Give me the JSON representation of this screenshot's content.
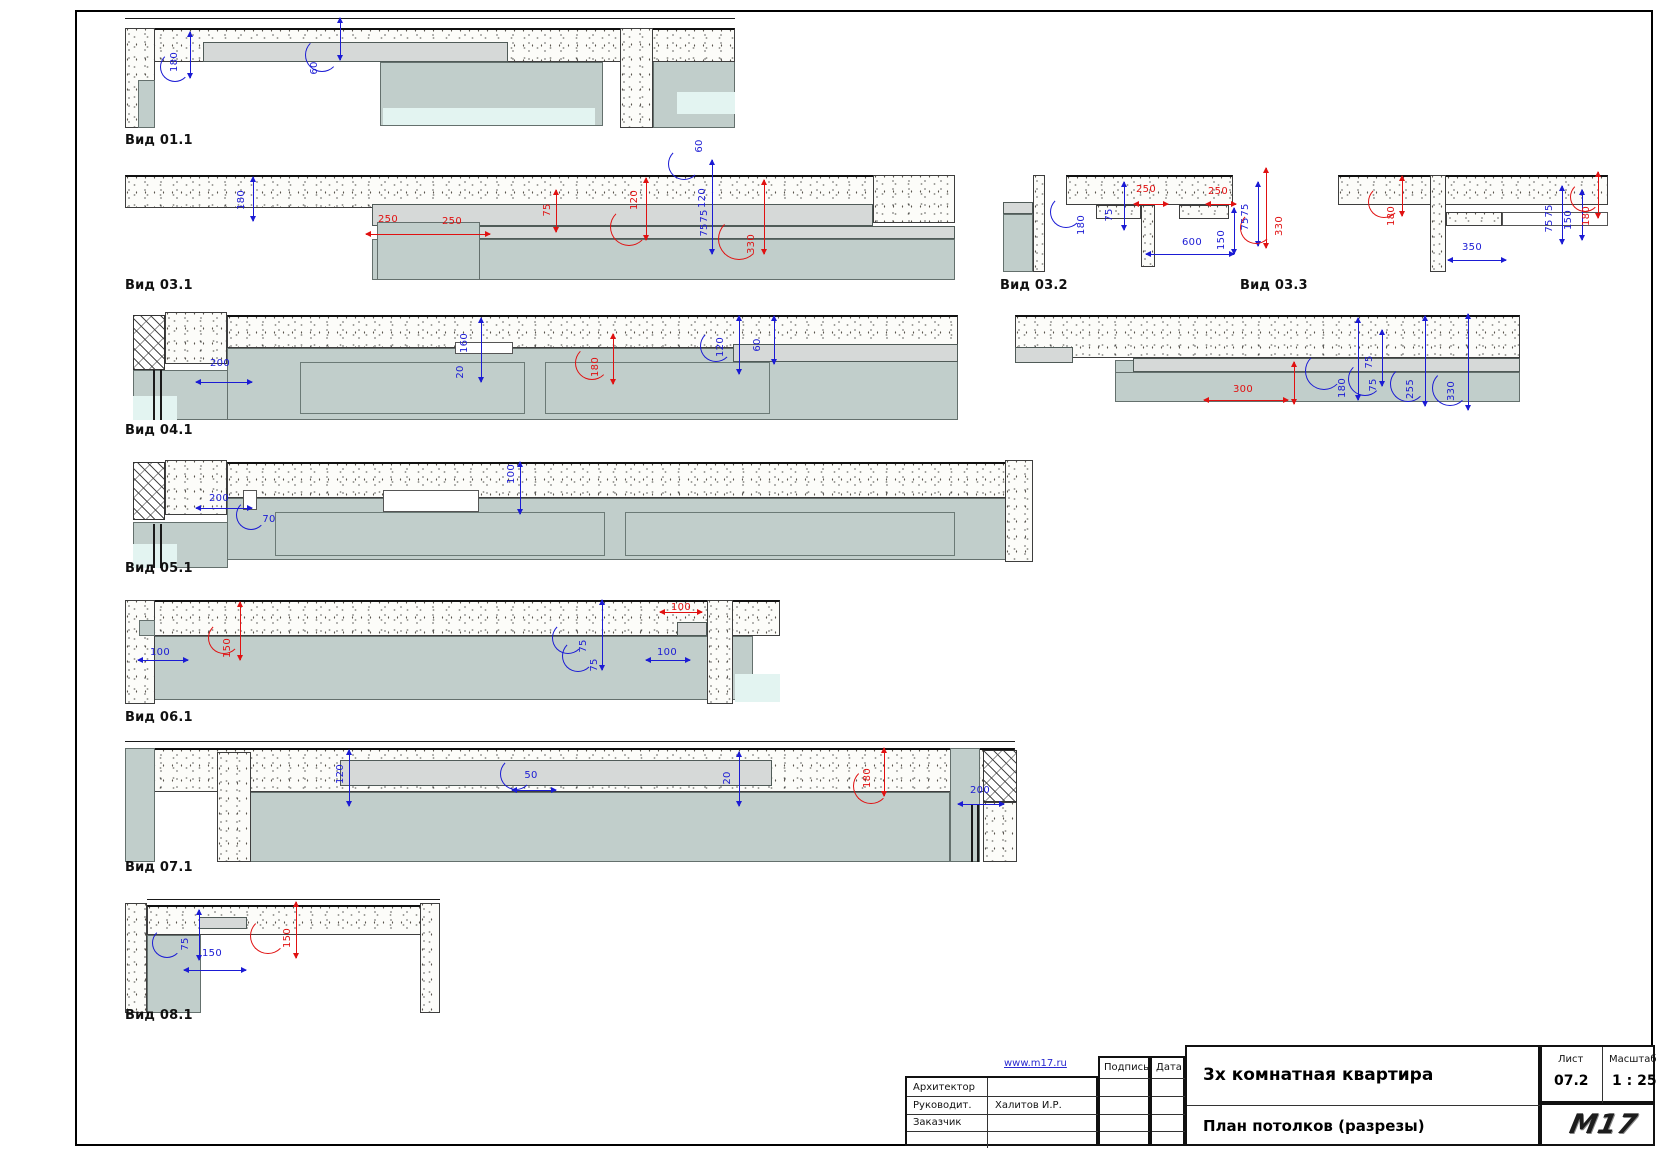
{
  "views": [
    {
      "label": "Вид 01.1"
    },
    {
      "label": "Вид 03.1"
    },
    {
      "label": "Вид 03.2"
    },
    {
      "label": "Вид 03.3"
    },
    {
      "label": "Вид 04.1"
    },
    {
      "label": "Вид 05.1"
    },
    {
      "label": "Вид 06.1"
    },
    {
      "label": "Вид 07.1"
    },
    {
      "label": "Вид 08.1"
    }
  ],
  "dimensions": [
    {
      "t": "180",
      "c": "b",
      "x": 175,
      "y": 62,
      "rot": true
    },
    {
      "t": "60",
      "c": "b",
      "x": 315,
      "y": 68,
      "rot": true
    },
    {
      "t": "180",
      "c": "b",
      "x": 242,
      "y": 200,
      "rot": true
    },
    {
      "t": "250",
      "c": "r",
      "x": 388,
      "y": 220,
      "rot": false
    },
    {
      "t": "250",
      "c": "r",
      "x": 452,
      "y": 222,
      "rot": false
    },
    {
      "t": "75",
      "c": "r",
      "x": 548,
      "y": 210,
      "rot": true
    },
    {
      "t": "120",
      "c": "r",
      "x": 635,
      "y": 200,
      "rot": true
    },
    {
      "t": "60",
      "c": "b",
      "x": 700,
      "y": 146,
      "rot": true
    },
    {
      "t": "120",
      "c": "b",
      "x": 703,
      "y": 198,
      "rot": true
    },
    {
      "t": "75",
      "c": "b",
      "x": 705,
      "y": 216,
      "rot": true
    },
    {
      "t": "75",
      "c": "b",
      "x": 705,
      "y": 230,
      "rot": true
    },
    {
      "t": "330",
      "c": "r",
      "x": 752,
      "y": 244,
      "rot": true
    },
    {
      "t": "180",
      "c": "b",
      "x": 1082,
      "y": 225,
      "rot": true
    },
    {
      "t": "75",
      "c": "b",
      "x": 1110,
      "y": 215,
      "rot": true
    },
    {
      "t": "250",
      "c": "r",
      "x": 1146,
      "y": 190,
      "rot": false
    },
    {
      "t": "250",
      "c": "r",
      "x": 1218,
      "y": 192,
      "rot": false
    },
    {
      "t": "600",
      "c": "b",
      "x": 1192,
      "y": 243,
      "rot": false
    },
    {
      "t": "150",
      "c": "b",
      "x": 1222,
      "y": 240,
      "rot": true
    },
    {
      "t": "75",
      "c": "b",
      "x": 1246,
      "y": 210,
      "rot": true
    },
    {
      "t": "75",
      "c": "b",
      "x": 1246,
      "y": 224,
      "rot": true
    },
    {
      "t": "330",
      "c": "r",
      "x": 1280,
      "y": 226,
      "rot": true
    },
    {
      "t": "180",
      "c": "r",
      "x": 1392,
      "y": 216,
      "rot": true
    },
    {
      "t": "350",
      "c": "b",
      "x": 1472,
      "y": 248,
      "rot": false
    },
    {
      "t": "75",
      "c": "b",
      "x": 1550,
      "y": 211,
      "rot": true
    },
    {
      "t": "75",
      "c": "b",
      "x": 1550,
      "y": 226,
      "rot": true
    },
    {
      "t": "150",
      "c": "b",
      "x": 1569,
      "y": 220,
      "rot": true
    },
    {
      "t": "180",
      "c": "r",
      "x": 1587,
      "y": 216,
      "rot": true
    },
    {
      "t": "200",
      "c": "b",
      "x": 220,
      "y": 364,
      "rot": false
    },
    {
      "t": "160",
      "c": "b",
      "x": 465,
      "y": 343,
      "rot": true
    },
    {
      "t": "20",
      "c": "b",
      "x": 461,
      "y": 372,
      "rot": true
    },
    {
      "t": "180",
      "c": "r",
      "x": 596,
      "y": 367,
      "rot": true
    },
    {
      "t": "120",
      "c": "b",
      "x": 721,
      "y": 347,
      "rot": true
    },
    {
      "t": "60",
      "c": "b",
      "x": 758,
      "y": 345,
      "rot": true
    },
    {
      "t": "300",
      "c": "r",
      "x": 1243,
      "y": 390,
      "rot": false
    },
    {
      "t": "180",
      "c": "b",
      "x": 1343,
      "y": 388,
      "rot": true
    },
    {
      "t": "75",
      "c": "b",
      "x": 1370,
      "y": 362,
      "rot": true
    },
    {
      "t": "75",
      "c": "b",
      "x": 1374,
      "y": 385,
      "rot": true
    },
    {
      "t": "255",
      "c": "b",
      "x": 1411,
      "y": 389,
      "rot": true
    },
    {
      "t": "330",
      "c": "b",
      "x": 1452,
      "y": 391,
      "rot": true
    },
    {
      "t": "200",
      "c": "b",
      "x": 219,
      "y": 499,
      "rot": false
    },
    {
      "t": "70",
      "c": "b",
      "x": 269,
      "y": 520,
      "rot": false
    },
    {
      "t": "100",
      "c": "b",
      "x": 512,
      "y": 474,
      "rot": true
    },
    {
      "t": "100",
      "c": "b",
      "x": 160,
      "y": 653,
      "rot": false
    },
    {
      "t": "150",
      "c": "r",
      "x": 228,
      "y": 648,
      "rot": true
    },
    {
      "t": "75",
      "c": "b",
      "x": 584,
      "y": 646,
      "rot": true
    },
    {
      "t": "75",
      "c": "b",
      "x": 595,
      "y": 665,
      "rot": true
    },
    {
      "t": "100",
      "c": "r",
      "x": 681,
      "y": 608,
      "rot": false
    },
    {
      "t": "100",
      "c": "b",
      "x": 667,
      "y": 653,
      "rot": false
    },
    {
      "t": "120",
      "c": "b",
      "x": 341,
      "y": 774,
      "rot": true
    },
    {
      "t": "50",
      "c": "b",
      "x": 531,
      "y": 776,
      "rot": false
    },
    {
      "t": "20",
      "c": "b",
      "x": 728,
      "y": 778,
      "rot": true
    },
    {
      "t": "180",
      "c": "r",
      "x": 868,
      "y": 778,
      "rot": true
    },
    {
      "t": "200",
      "c": "b",
      "x": 980,
      "y": 791,
      "rot": false
    },
    {
      "t": "75",
      "c": "b",
      "x": 186,
      "y": 944,
      "rot": true
    },
    {
      "t": "150",
      "c": "b",
      "x": 212,
      "y": 954,
      "rot": false
    },
    {
      "t": "150",
      "c": "r",
      "x": 288,
      "y": 938,
      "rot": true
    }
  ],
  "title_block": {
    "website": "www.m17.ru",
    "sign_col": "Подпись",
    "date_col": "Дата",
    "rows": [
      {
        "label": "Архитектор",
        "value": ""
      },
      {
        "label": "Руководит.",
        "value": "Халитов И.Р."
      },
      {
        "label": "Заказчик",
        "value": ""
      }
    ],
    "project": "3х комнатная квартира",
    "drawing": "План потолков (разрезы)",
    "sheet_label": "Лист",
    "sheet_no": "07.2",
    "scale_label": "Масштаб",
    "scale": "1 : 25",
    "logo": "M17"
  }
}
